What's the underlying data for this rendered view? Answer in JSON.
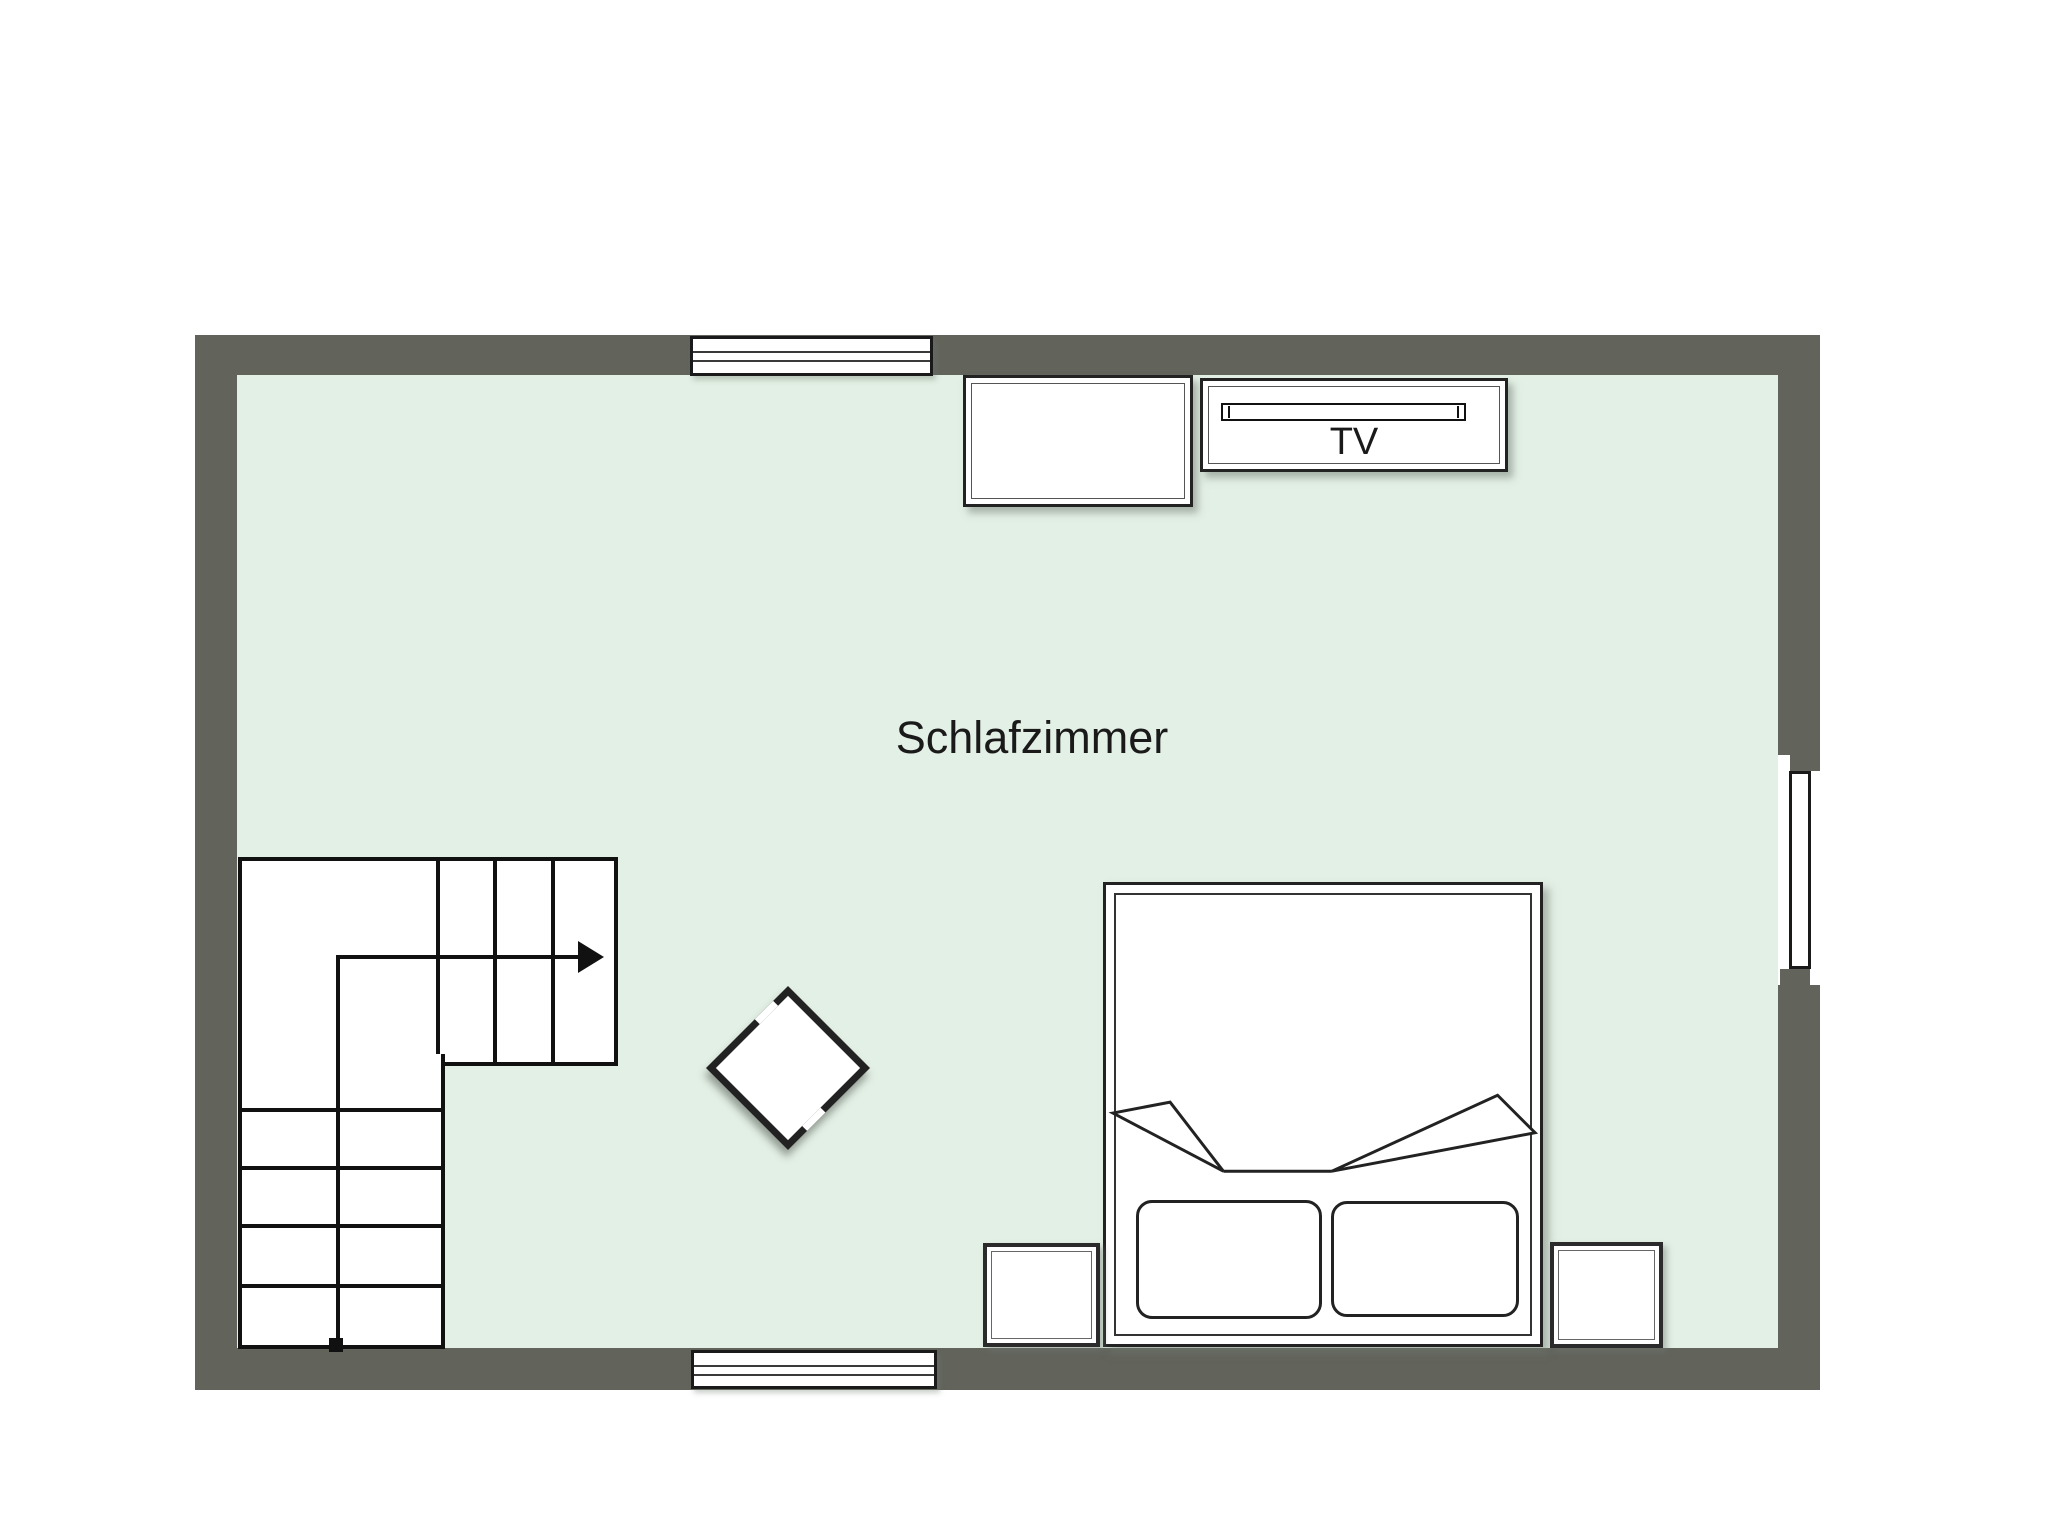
{
  "floorplan": {
    "room": {
      "label": "Schlafzimmer"
    },
    "furniture": {
      "tv": {
        "label": "TV"
      }
    },
    "colors": {
      "wall": "#62645c",
      "floor": "#e3f0e5",
      "line": "#1a1a1a",
      "bg": "#ffffff",
      "fill": "#ffffff"
    }
  }
}
